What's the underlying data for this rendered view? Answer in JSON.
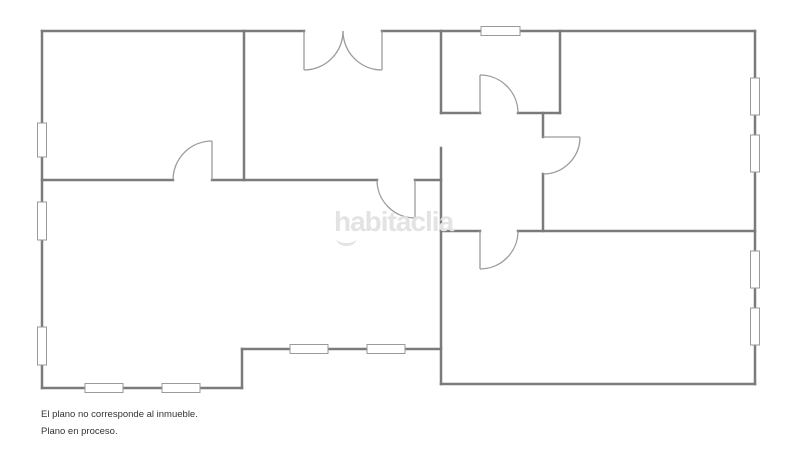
{
  "watermark": {
    "text": "habitaclia"
  },
  "disclaimer": {
    "line1": "El plano no corresponde al inmueble.",
    "line2": "Plano en proceso."
  },
  "colors": {
    "background": "#ffffff",
    "wall": "#7b7b7b",
    "door": "#9b9b9b",
    "window_border": "#9a9a9a",
    "window_fill": "#ffffff",
    "watermark": "#e3e3e3",
    "text": "#333333"
  },
  "floorplan": {
    "canvas": {
      "width": 800,
      "height": 450
    },
    "wall_thickness": 2.5,
    "door_stroke": 1.3,
    "walls": [
      [
        42,
        31,
        304,
        31
      ],
      [
        382,
        31,
        755,
        31
      ],
      [
        42,
        31,
        42,
        388
      ],
      [
        42,
        388,
        242,
        388
      ],
      [
        242,
        388,
        242,
        349
      ],
      [
        242,
        349,
        441,
        349
      ],
      [
        441,
        384,
        755,
        384
      ],
      [
        755,
        31,
        755,
        384
      ],
      [
        244,
        31,
        244,
        180
      ],
      [
        42,
        180,
        173,
        180
      ],
      [
        212,
        180,
        377,
        180
      ],
      [
        415,
        180,
        441,
        180
      ],
      [
        441,
        31,
        441,
        113
      ],
      [
        441,
        148,
        441,
        384
      ],
      [
        441,
        113,
        480,
        113
      ],
      [
        518,
        113,
        560,
        113
      ],
      [
        560,
        31,
        560,
        113
      ],
      [
        543,
        113,
        543,
        137
      ],
      [
        543,
        174,
        543,
        231
      ],
      [
        441,
        231,
        480,
        231
      ],
      [
        518,
        231,
        755,
        231
      ]
    ],
    "doors": [
      {
        "name": "entrance-double-door-left",
        "leaf": [
          304,
          31,
          304,
          70
        ],
        "arc": "M 343 31 A 39 39 0 0 1 304 70"
      },
      {
        "name": "entrance-double-door-right",
        "leaf": [
          382,
          31,
          382,
          70
        ],
        "arc": "M 343 31 A 39 39 0 0 0 382 70"
      },
      {
        "name": "door-top-left-room",
        "leaf": [
          212,
          180,
          212,
          141
        ],
        "arc": "M 212 141 A 39 39 0 0 0 173 180"
      },
      {
        "name": "door-living-room",
        "leaf": [
          415,
          180,
          415,
          218
        ],
        "arc": "M 415 218 A 38 38 0 0 1 377 180"
      },
      {
        "name": "door-small-room",
        "leaf": [
          480,
          113,
          480,
          75
        ],
        "arc": "M 480 75 A 38 38 0 0 1 518 113"
      },
      {
        "name": "door-right-room",
        "leaf": [
          543,
          137,
          580,
          137
        ],
        "arc": "M 580 137 A 37 37 0 0 1 543 174"
      },
      {
        "name": "door-bottom-right-room",
        "leaf": [
          480,
          231,
          480,
          269
        ],
        "arc": "M 480 269 A 38 38 0 0 0 518 231"
      }
    ],
    "windows": [
      [
        37.5,
        123,
        9,
        34
      ],
      [
        37.5,
        202,
        9,
        38
      ],
      [
        37.5,
        327,
        9,
        38
      ],
      [
        481,
        26.5,
        39,
        9
      ],
      [
        750.5,
        78,
        9,
        37
      ],
      [
        750.5,
        135,
        9,
        37
      ],
      [
        750.5,
        251,
        9,
        37
      ],
      [
        750.5,
        308,
        9,
        37
      ],
      [
        85,
        383.5,
        38,
        9
      ],
      [
        162,
        383.5,
        38,
        9
      ],
      [
        290,
        344.5,
        38,
        9
      ],
      [
        367,
        344.5,
        38,
        9
      ]
    ]
  }
}
